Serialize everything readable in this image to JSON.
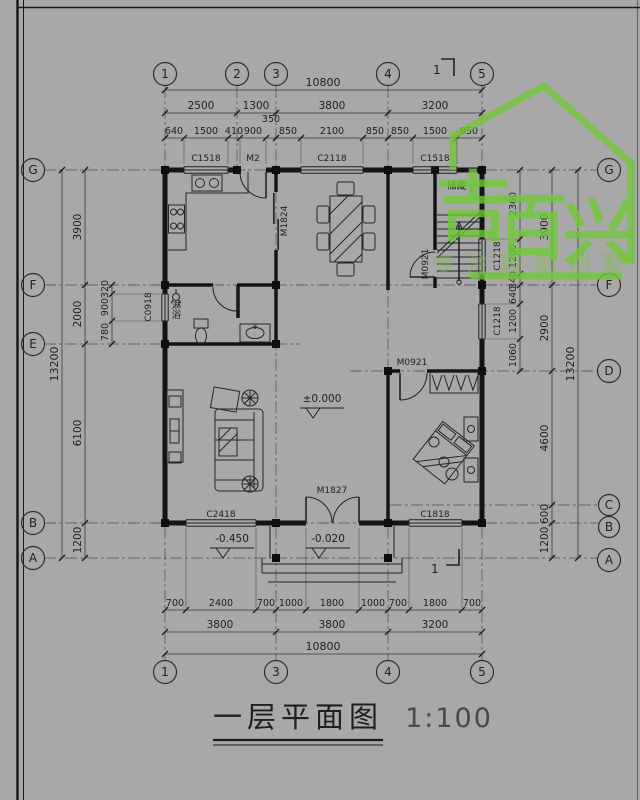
{
  "title": {
    "text": "一层平面图",
    "scale": "1:100"
  },
  "watermark": {
    "chars": [
      "吉",
      "百",
      "兴"
    ],
    "tagline": "专注轻钢别墅",
    "color": "#70c837"
  },
  "grid": {
    "top": [
      "1",
      "2",
      "3",
      "4",
      "5"
    ],
    "bottom": [
      "1",
      "3",
      "4",
      "5"
    ],
    "left": [
      "G",
      "F",
      "E",
      "B",
      "A"
    ],
    "right": [
      "G",
      "F",
      "D",
      "C",
      "B",
      "A"
    ]
  },
  "dims": {
    "top_total": "10800",
    "top_segments": [
      "2500",
      "1300",
      "3800",
      "3200"
    ],
    "top_detail": [
      "640",
      "1500",
      "410",
      "900",
      "350",
      "850",
      "2100",
      "850",
      "850",
      "1500",
      "850"
    ],
    "bottom_detail": [
      "700",
      "2400",
      "700",
      "1000",
      "1800",
      "1000",
      "700",
      "1800",
      "700"
    ],
    "bottom_segments": [
      "3800",
      "3800",
      "3200"
    ],
    "bottom_total": "10800",
    "left_total": "13200",
    "left_main": [
      "3900",
      "2000",
      "6100",
      "1200"
    ],
    "left_detail": [
      "320",
      "900",
      "780"
    ],
    "right_total": "13200",
    "right_main": [
      "3900",
      "2900",
      "4600",
      "600",
      "1200"
    ],
    "right_detail": [
      "2360",
      "1200",
      "340",
      "640",
      "1200",
      "1060"
    ]
  },
  "openings": {
    "top": [
      "C1518",
      "M2",
      "C2118",
      "C1518"
    ],
    "bottom": [
      "C2418",
      "M1827",
      "C1818"
    ],
    "left": [
      "C0918"
    ],
    "right": [
      "C1218",
      "C1218"
    ],
    "interior": [
      "M1824",
      "M0921",
      "M0921"
    ]
  },
  "rooms": {
    "storage": "储藏",
    "shower": "淋浴"
  },
  "levels": {
    "main": "±0.000",
    "porch": "-0.020",
    "yard": "-0.450"
  },
  "section": {
    "label": "1"
  }
}
